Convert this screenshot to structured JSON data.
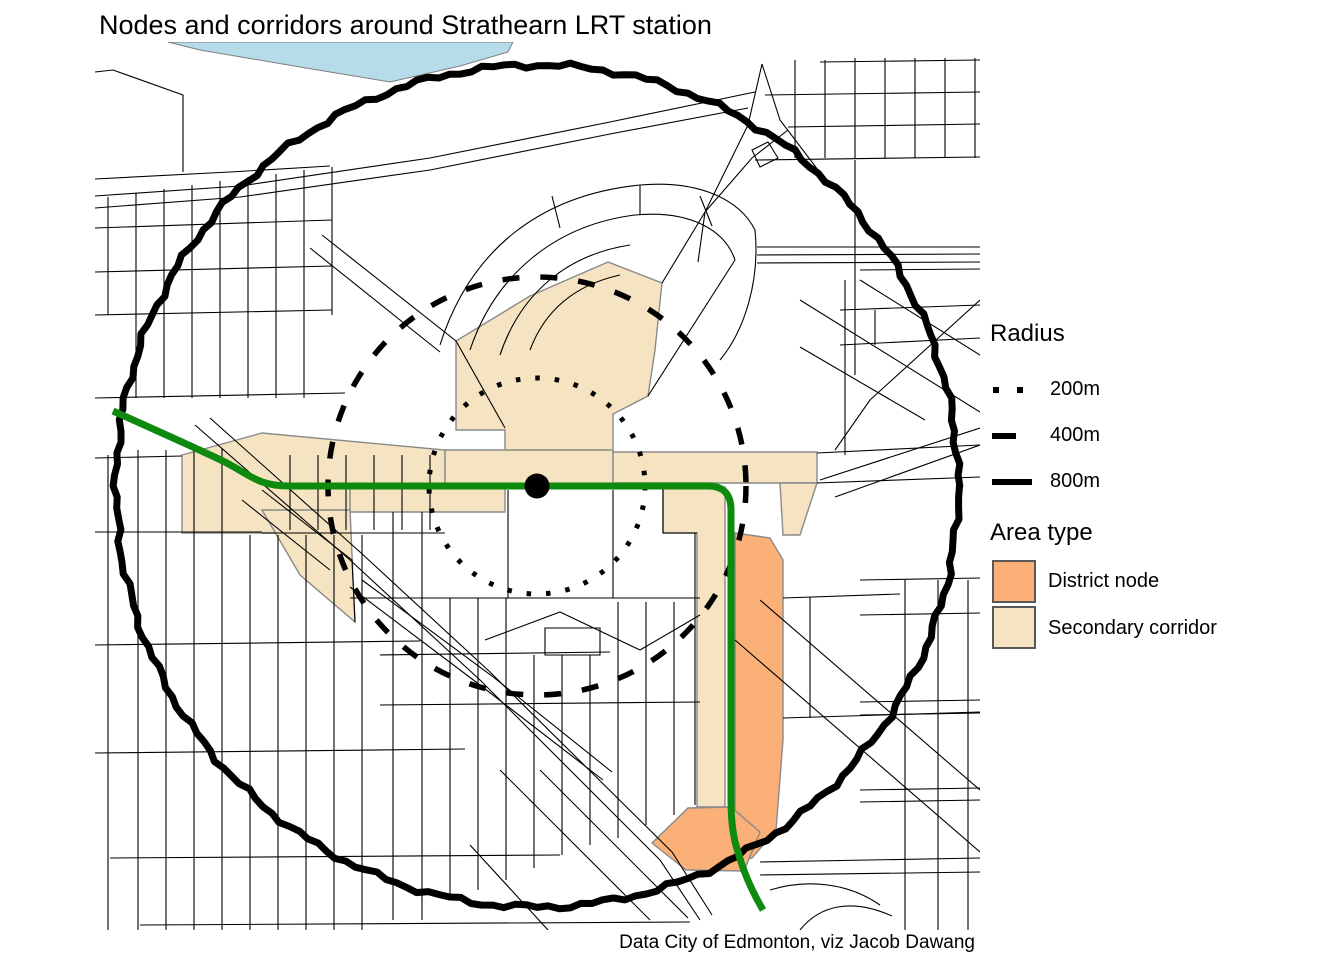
{
  "title": "Nodes and corridors around Strathearn LRT station",
  "caption": "Data City of Edmonton, viz Jacob Dawang",
  "legend": {
    "radius": {
      "title": "Radius",
      "items": [
        {
          "label": "200m",
          "style": "dotted"
        },
        {
          "label": "400m",
          "style": "dashed"
        },
        {
          "label": "800m",
          "style": "solid"
        }
      ]
    },
    "area_type": {
      "title": "Area type",
      "items": [
        {
          "label": "District node",
          "color": "#FBB077"
        },
        {
          "label": "Secondary corridor",
          "color": "#F5E3C1"
        }
      ]
    }
  },
  "map": {
    "station": {
      "name": "Strathearn LRT station",
      "marker_color": "#000000"
    },
    "colors": {
      "lrt_line": "#0E8B0E",
      "street": "#000000",
      "river": "#B5DCE8",
      "river_border": "#7F7F7F",
      "area_border": "#8A8A8A",
      "district_node": "#FBB077",
      "secondary_corridor": "#F5E3C1",
      "circle": "#000000",
      "background": "#FFFFFF"
    },
    "circles": [
      {
        "label": "200m",
        "radius_px": 108,
        "style": "dotted"
      },
      {
        "label": "400m",
        "radius_px": 209,
        "style": "dashed"
      },
      {
        "label": "800m",
        "radius_px": 421,
        "style": "solid"
      }
    ],
    "center_px": {
      "x": 537,
      "y": 486
    }
  }
}
